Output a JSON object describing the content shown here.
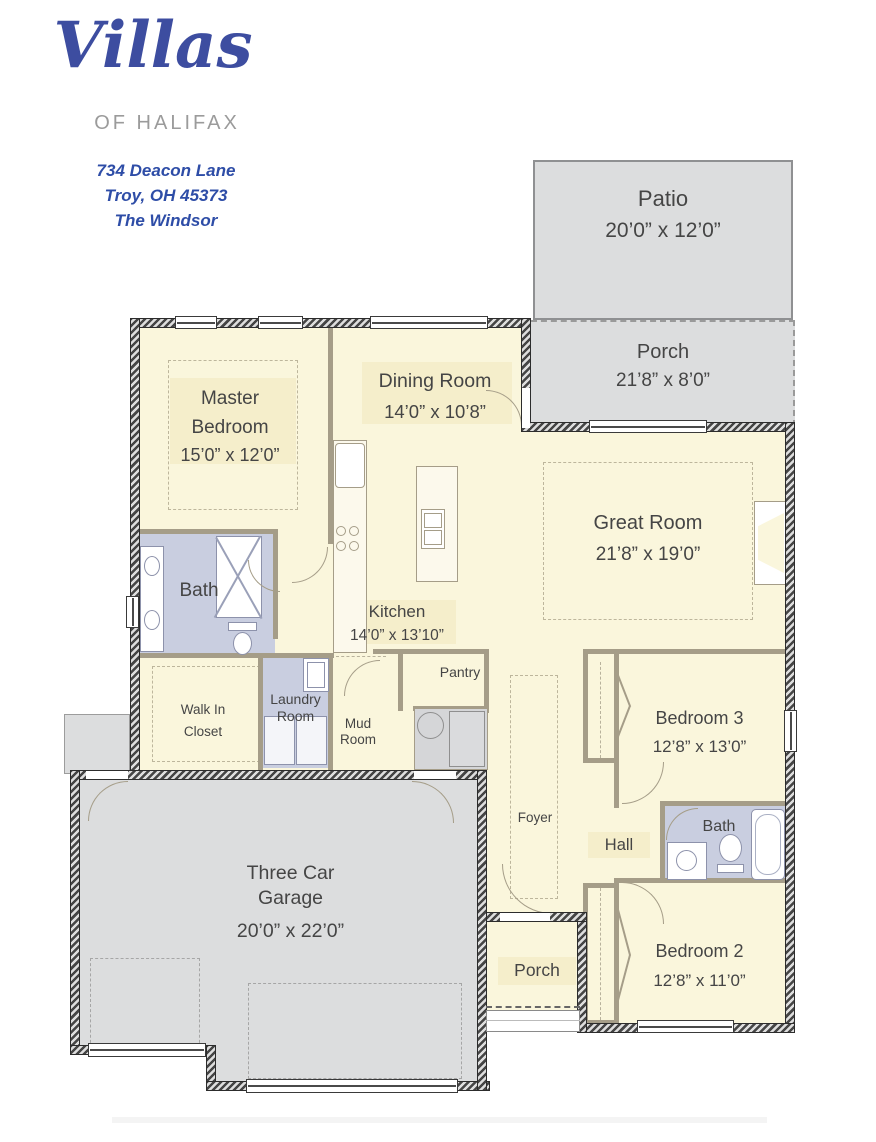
{
  "header": {
    "logo_script": "Villas",
    "logo_subtitle": "of Halifax",
    "address_line1": "734 Deacon Lane",
    "address_line2": "Troy, OH 45373",
    "plan_name": "The Windsor"
  },
  "colors": {
    "logo_blue": "#3d4da0",
    "logo_gray": "#9b9b9b",
    "address_blue": "#2e4da7",
    "room_fill": "#faf6dc",
    "bath_fill": "#c9cee0",
    "concrete_fill": "#dcddde",
    "exterior_wall": "#454545",
    "interior_wall": "#a59d88",
    "label_text": "#454545"
  },
  "rooms": {
    "patio": {
      "name": "Patio",
      "dims": "20’0” x 12’0”"
    },
    "rear_porch": {
      "name": "Porch",
      "dims": "21’8” x 8’0”"
    },
    "master_bedroom": {
      "line1": "Master",
      "line2": "Bedroom",
      "dims": "15’0” x 12’0”"
    },
    "dining_room": {
      "name": "Dining Room",
      "dims": "14’0” x 10’8”"
    },
    "great_room": {
      "name": "Great Room",
      "dims": "21’8” x 19’0”"
    },
    "kitchen": {
      "name": "Kitchen",
      "dims": "14’0” x 13’10”"
    },
    "master_bath": {
      "name": "Bath"
    },
    "walk_in_closet": {
      "line1": "Walk In",
      "line2": "Closet"
    },
    "laundry_room": {
      "line1": "Laundry",
      "line2": "Room"
    },
    "mud_room": {
      "line1": "Mud",
      "line2": "Room"
    },
    "pantry": {
      "name": "Pantry"
    },
    "bedroom3": {
      "name": "Bedroom 3",
      "dims": "12’8” x 13’0”"
    },
    "foyer": {
      "name": "Foyer"
    },
    "hall": {
      "name": "Hall"
    },
    "hall_bath": {
      "name": "Bath"
    },
    "garage": {
      "line1": "Three Car",
      "line2": "Garage",
      "dims": "20’0” x 22’0”"
    },
    "front_porch": {
      "name": "Porch"
    },
    "bedroom2": {
      "name": "Bedroom 2",
      "dims": "12’8” x 11’0”"
    }
  }
}
